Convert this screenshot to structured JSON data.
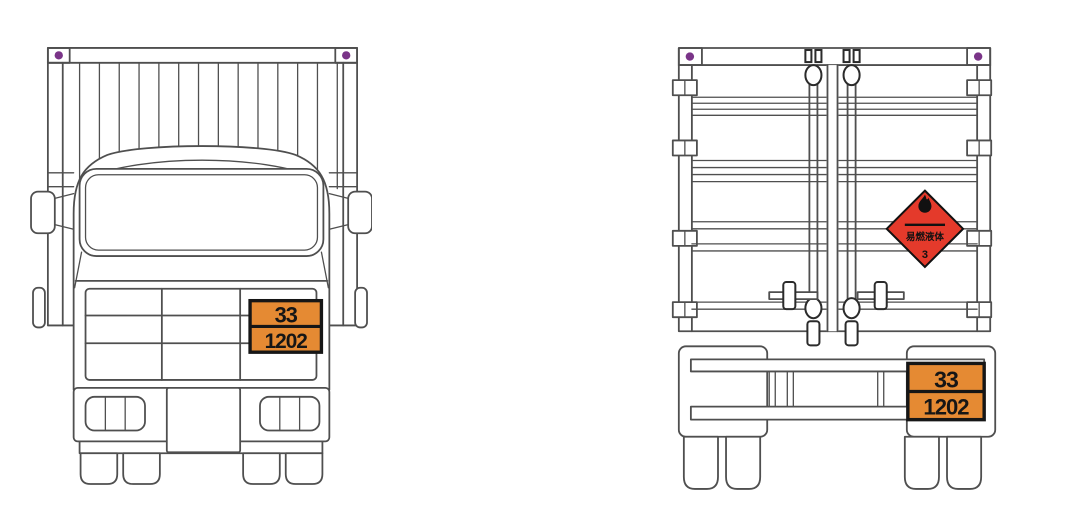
{
  "colors": {
    "background": "#ffffff",
    "line_gray": "#4f4f4f",
    "placard_orange": "#e58a33",
    "hazard_red": "#e43a2b",
    "corner_marker_purple": "#7a3488",
    "ink": "#161616"
  },
  "front": {
    "placard": {
      "top": "33",
      "bottom": "1202"
    }
  },
  "rear": {
    "placard": {
      "top": "33",
      "bottom": "1202"
    },
    "diamond": {
      "text": "易燃液体",
      "class_number": "3"
    }
  }
}
